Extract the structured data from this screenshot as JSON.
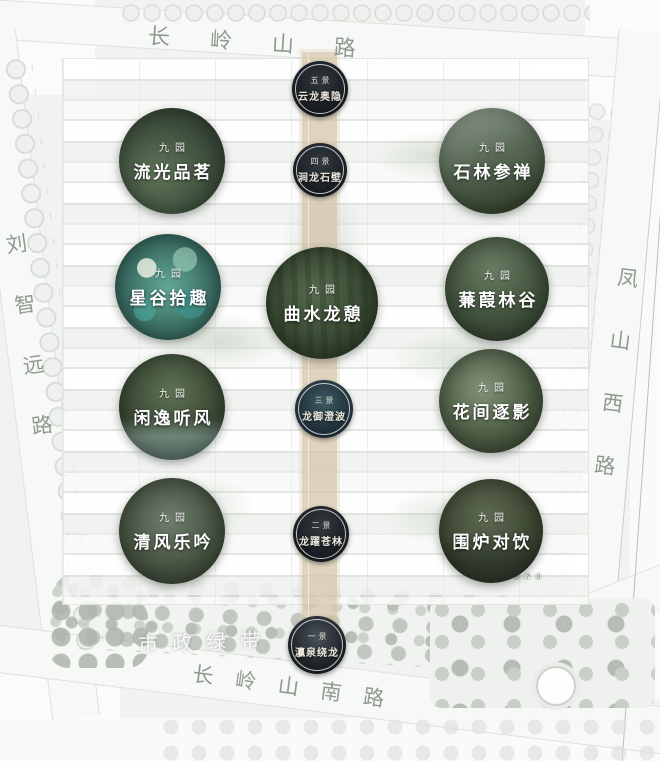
{
  "map": {
    "roads": {
      "top": "长岭山路",
      "left": "刘智远路",
      "right": "凤山西路",
      "bottom": "长岭山南路"
    },
    "green_belt_label": "市政绿带",
    "phase_markers": "⑥⑦⑧",
    "axis_nodes": [
      {
        "order": "五景",
        "name": "云龙奥隐"
      },
      {
        "order": "四景",
        "name": "涧龙石壁"
      },
      {
        "order": "三景",
        "name": "龙御澄波"
      },
      {
        "order": "二景",
        "name": "龙躍苍林"
      },
      {
        "order": "一景",
        "name": "灜泉绕龙"
      }
    ],
    "gardens": [
      {
        "tag": "九园",
        "name": "流光品茗"
      },
      {
        "tag": "九园",
        "name": "石林参禅"
      },
      {
        "tag": "九园",
        "name": "星谷拾趣"
      },
      {
        "tag": "九园",
        "name": "蒹葭林谷"
      },
      {
        "tag": "九园",
        "name": "曲水龙憩"
      },
      {
        "tag": "九园",
        "name": "闲逸听风"
      },
      {
        "tag": "九园",
        "name": "花间逐影"
      },
      {
        "tag": "九园",
        "name": "清风乐吟"
      },
      {
        "tag": "九园",
        "name": "围炉对饮"
      }
    ],
    "colors": {
      "axis_band": "#d5c3a6",
      "node_circle": "#171b1f",
      "garden_green": "#3c4c3e",
      "accent_teal": "#3f8f86",
      "road_text": "#878e87",
      "map_base": "#f1f3f0"
    }
  }
}
